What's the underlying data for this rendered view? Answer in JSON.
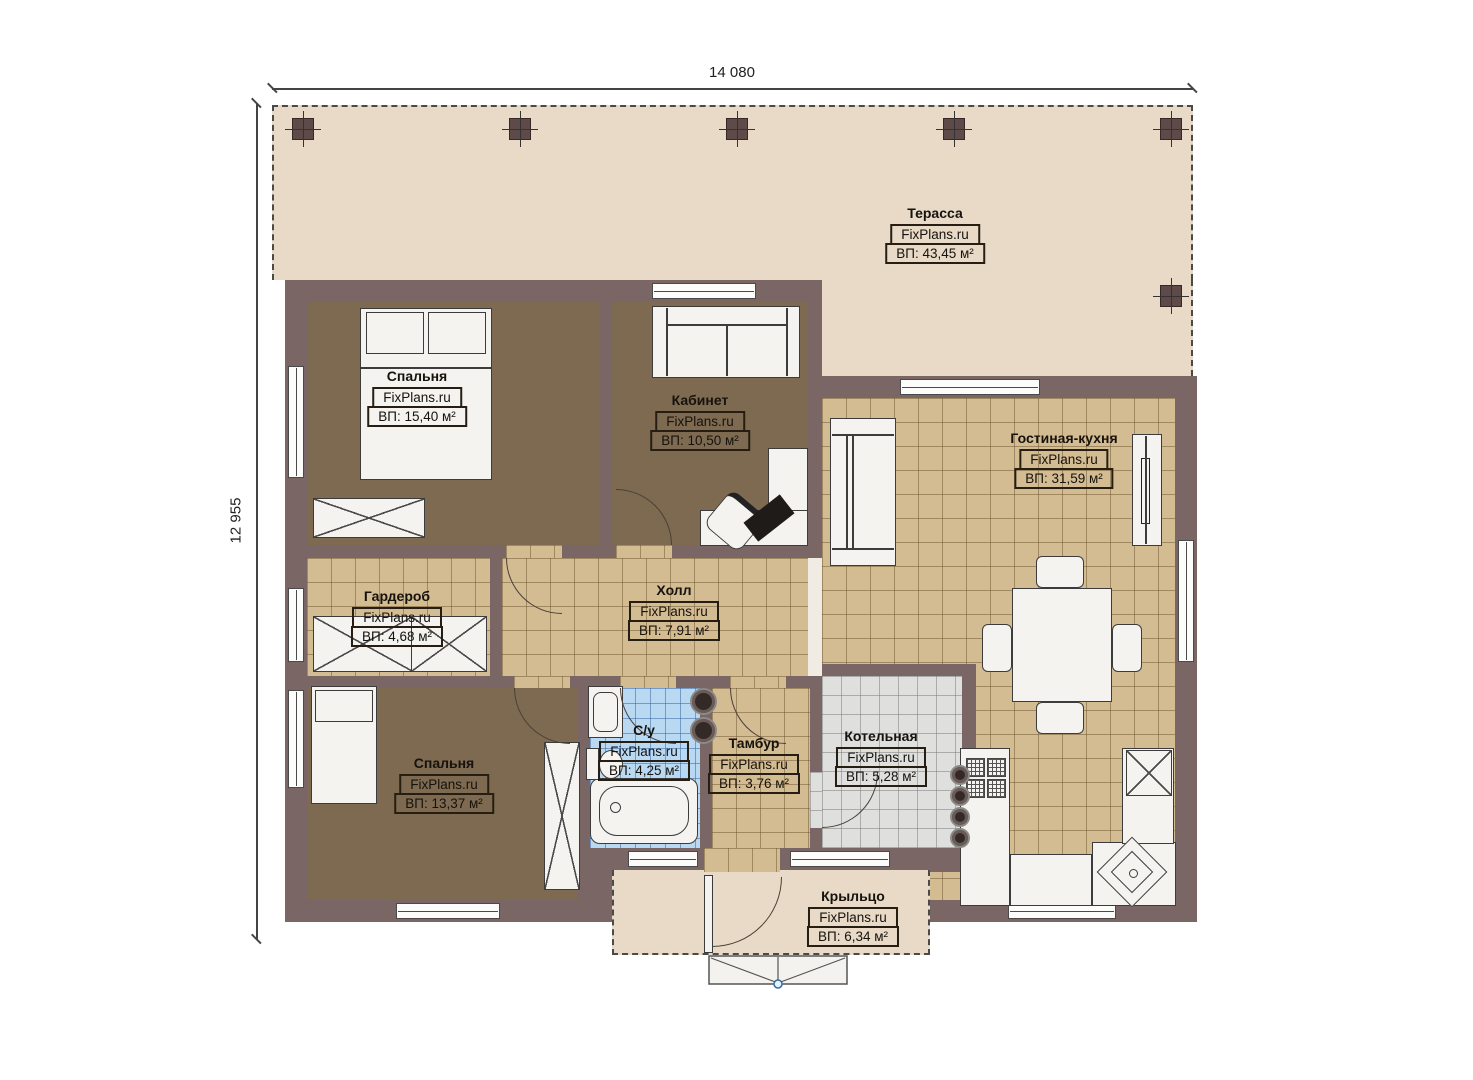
{
  "site_brand": "FixPlans.ru",
  "dimensions": {
    "width": "14 080",
    "height": "12 955"
  },
  "rooms": [
    {
      "name": "Терасса",
      "brand": "FixPlans.ru",
      "area": "ВП: 43,45 м²"
    },
    {
      "name": "Спальня",
      "brand": "FixPlans.ru",
      "area": "ВП: 15,40 м²"
    },
    {
      "name": "Кабинет",
      "brand": "FixPlans.ru",
      "area": "ВП: 10,50 м²"
    },
    {
      "name": "Гостиная-кухня",
      "brand": "FixPlans.ru",
      "area": "ВП: 31,59 м²"
    },
    {
      "name": "Гардероб",
      "brand": "FixPlans.ru",
      "area": "ВП: 4,68 м²"
    },
    {
      "name": "Холл",
      "brand": "FixPlans.ru",
      "area": "ВП: 7,91 м²"
    },
    {
      "name": "Спальня",
      "brand": "FixPlans.ru",
      "area": "ВП: 13,37 м²"
    },
    {
      "name": "С/у",
      "brand": "FixPlans.ru",
      "area": "ВП: 4,25 м²"
    },
    {
      "name": "Тамбур",
      "brand": "FixPlans.ru",
      "area": "ВП: 3,76 м²"
    },
    {
      "name": "Котельная",
      "brand": "FixPlans.ru",
      "area": "ВП: 5,28 м²"
    },
    {
      "name": "Крыльцо",
      "brand": "FixPlans.ru",
      "area": "ВП: 6,34 м²"
    }
  ],
  "colors": {
    "wall": "#7a6765",
    "terrace": "#e8dac6",
    "room_brown": "#7d6a50",
    "tile_tan": "#d3bb92",
    "tile_blue": "#b9d8f2",
    "tile_gray": "#dfdfdd",
    "label_border": "#261e12"
  }
}
